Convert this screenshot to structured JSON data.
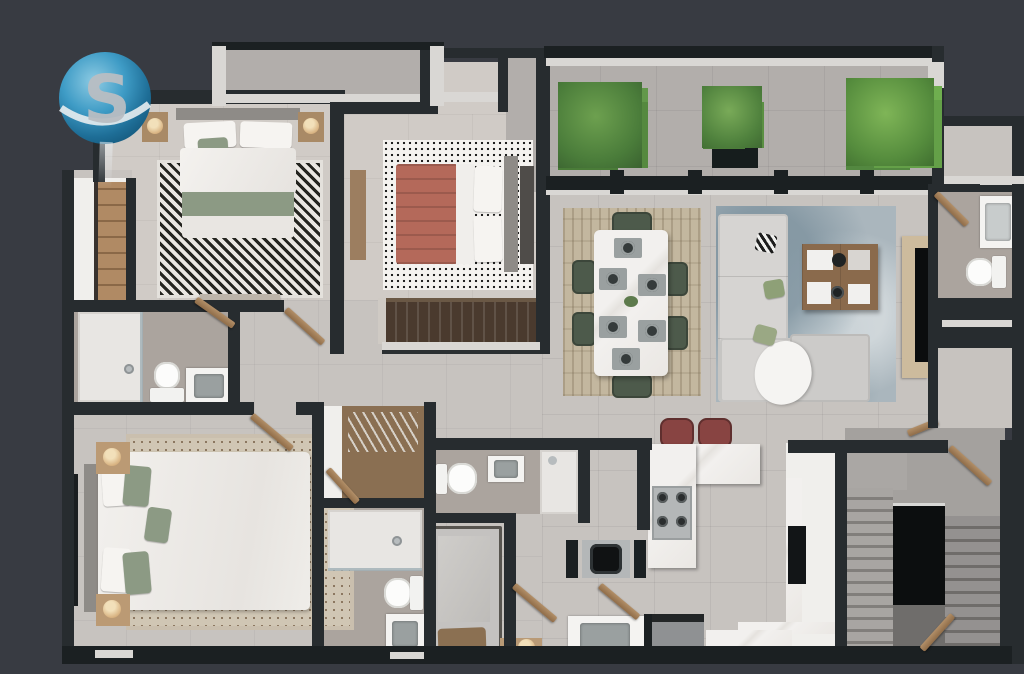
{
  "canvas": {
    "width": 1024,
    "height": 674
  },
  "logo": {
    "letter": "S",
    "shape": "blue-sphere-with-white-swoosh",
    "sphere_color": "#3f9cc6",
    "sphere_highlight": "#8ecbe3",
    "sphere_shadow": "#155a7e",
    "letter_color": "#b9bec3",
    "swoosh_color": "#e8edf0"
  },
  "palette": {
    "bg": "#383b42",
    "wall": "#272c2f",
    "wall-dark": "#1b2022",
    "trim": "#d9d7d4",
    "floor-a": "#d0cbc6",
    "floor-b": "#c7c3bf",
    "floor-bath": "#aba49e",
    "terrace": "#b2aeab",
    "wood": "#a98a66",
    "wood-dark": "#4a3a2e",
    "wood-mid": "#8a6a4c",
    "shelf-wood": "#b08a64",
    "console-wood": "#cdbb9d",
    "headboard": "#8e8b87",
    "green": "#8c9a84",
    "green-dark": "#5d7a4c",
    "chair": "#4d5a4b",
    "red-blanket": "#b4695a",
    "stool": "#884442",
    "rug-tan": "#c3b79f",
    "rug-blue": "#aab6bd",
    "sofa": "#d6d4d2",
    "ottoman": "#cccbc9",
    "steel": "#b4b7b8",
    "stair": "#a4a19e",
    "core": "#0c0e0f",
    "under-core": "#6f6d6b",
    "lamp": "#d9b483",
    "plant": "#5d8f45",
    "plant-dark": "#3f6d33",
    "basin": "#9aa0a0",
    "tv": "#0b0d0e"
  },
  "floorplan": {
    "type": "3d-top-down-apartment-render",
    "rooms": [
      {
        "id": "bedroom-1",
        "furniture": [
          "double-bed-white-green",
          "chevron-rug",
          "nightstand-left",
          "nightstand-right",
          "table-lamp-x2",
          "foot-bench",
          "built-in-closet-with-mirror",
          "window-wall",
          "small-balcony"
        ]
      },
      {
        "id": "bedroom-2",
        "furniture": [
          "double-bed-terracotta-throw",
          "speckled-rug",
          "dresser",
          "dark-wood-wardrobe",
          "side-bench"
        ]
      },
      {
        "id": "master-bedroom",
        "furniture": [
          "king-bed-white-green-pillows",
          "dotted-area-rug",
          "headboard",
          "nightstand-x2",
          "table-lamp-x2",
          "french-window"
        ]
      },
      {
        "id": "service-bedroom",
        "furniture": [
          "single-bed-brown-pillow"
        ]
      },
      {
        "id": "master-bathroom",
        "furniture": [
          "walk-in-shower",
          "toilet",
          "vanity-sink"
        ]
      },
      {
        "id": "bathroom-2",
        "furniture": [
          "walk-in-shower",
          "toilet",
          "vanity-sink"
        ]
      },
      {
        "id": "service-bathroom",
        "furniture": [
          "toilet",
          "sink",
          "shower"
        ]
      },
      {
        "id": "powder-room",
        "furniture": [
          "sink-cabinet",
          "toilet"
        ]
      },
      {
        "id": "walk-in-closet",
        "furniture": [
          "hanging-rail",
          "shelving",
          "white-wardrobe"
        ]
      },
      {
        "id": "terrace",
        "furniture": [
          "plant-x3",
          "black-planter-box",
          "sliding-glass-door-wall",
          "white-parapet"
        ]
      },
      {
        "id": "dining-area",
        "furniture": [
          "marble-dining-table",
          "dining-chair-x6",
          "place-setting-x6",
          "green-centerpiece",
          "patterned-tan-rug"
        ]
      },
      {
        "id": "living-room",
        "furniture": [
          "l-shaped-sectional-sofa",
          "ottoman",
          "fur-throw",
          "wood-coffee-table",
          "decor-trays",
          "blue-area-rug",
          "tv-console",
          "tv"
        ]
      },
      {
        "id": "kitchen",
        "furniture": [
          "l-shaped-marble-island",
          "gas-cooktop-4-burner",
          "bar-stool-x2",
          "white-cabinet-run",
          "fridge-nook",
          "washer"
        ]
      },
      {
        "id": "laundry",
        "furniture": [
          "utility-sink",
          "appliance",
          "marble-counter",
          "floor-lamp",
          "wood-bench"
        ]
      },
      {
        "id": "staircase",
        "furniture": [
          "flight-down",
          "flight-up",
          "black-core-wall",
          "landing",
          "handrail"
        ]
      },
      {
        "id": "hallway",
        "furniture": [
          "open-wood-door-x8"
        ]
      }
    ],
    "counts": {
      "plants": 3,
      "dining_chairs": 6,
      "place_settings": 6,
      "bar_stools": 2,
      "open_doors": 8,
      "bedrooms": 4,
      "bathrooms": 4
    }
  }
}
